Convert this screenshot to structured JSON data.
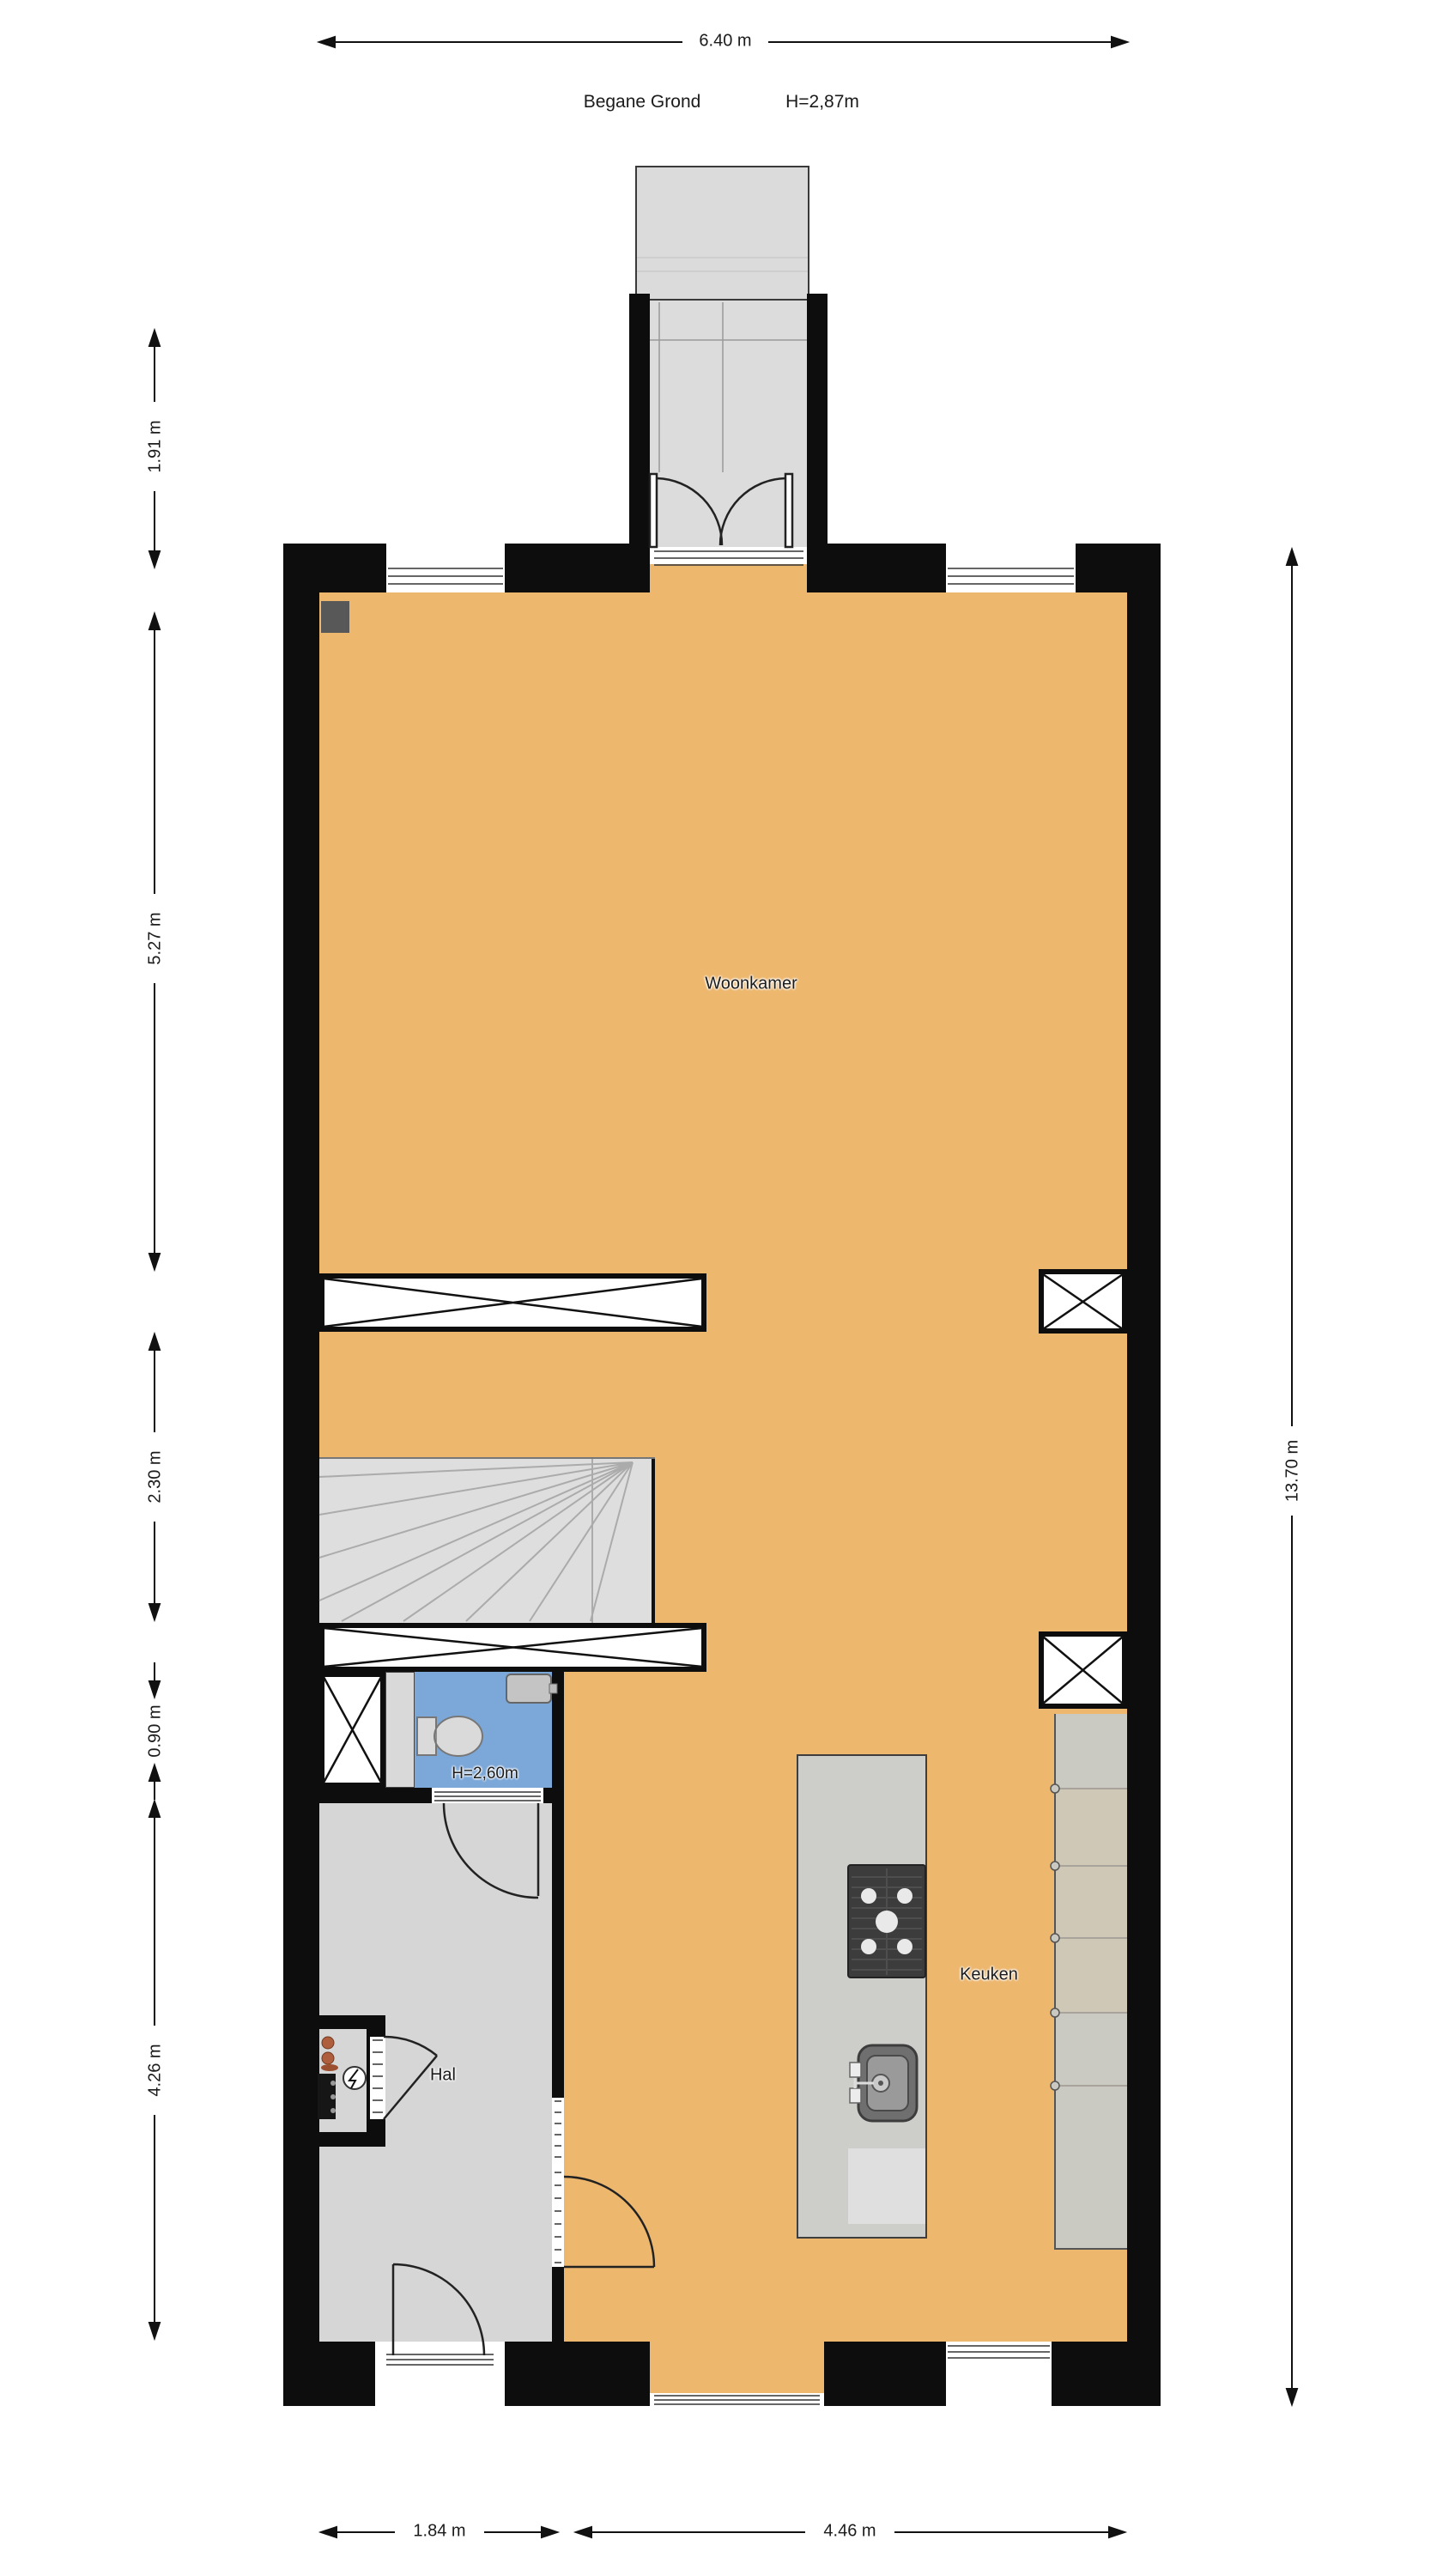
{
  "title": {
    "floor_name": "Begane Grond",
    "ceiling_height": "H=2,87m"
  },
  "rooms": {
    "living_room": "Woonkamer",
    "kitchen": "Keuken",
    "hallway": "Hal",
    "toilet_ceiling_height": "H=2,60m"
  },
  "dimensions": {
    "top_width": "6.40 m",
    "right_height": "13.70 m",
    "left": [
      "1.91 m",
      "5.27 m",
      "2.30 m",
      "0.90 m",
      "4.26 m"
    ],
    "bottom": [
      "1.84 m",
      "4.46 m"
    ]
  },
  "colors": {
    "wall": "#0d0d0d",
    "floor_main": "#EDB76E",
    "floor_hall": "#D6D6D6",
    "floor_toilet": "#7BA7D9",
    "porch": "#DBDBDB",
    "stairs": "#DEDEDE",
    "counter": "#CBCAC2",
    "stove": "#3C3C3C"
  }
}
